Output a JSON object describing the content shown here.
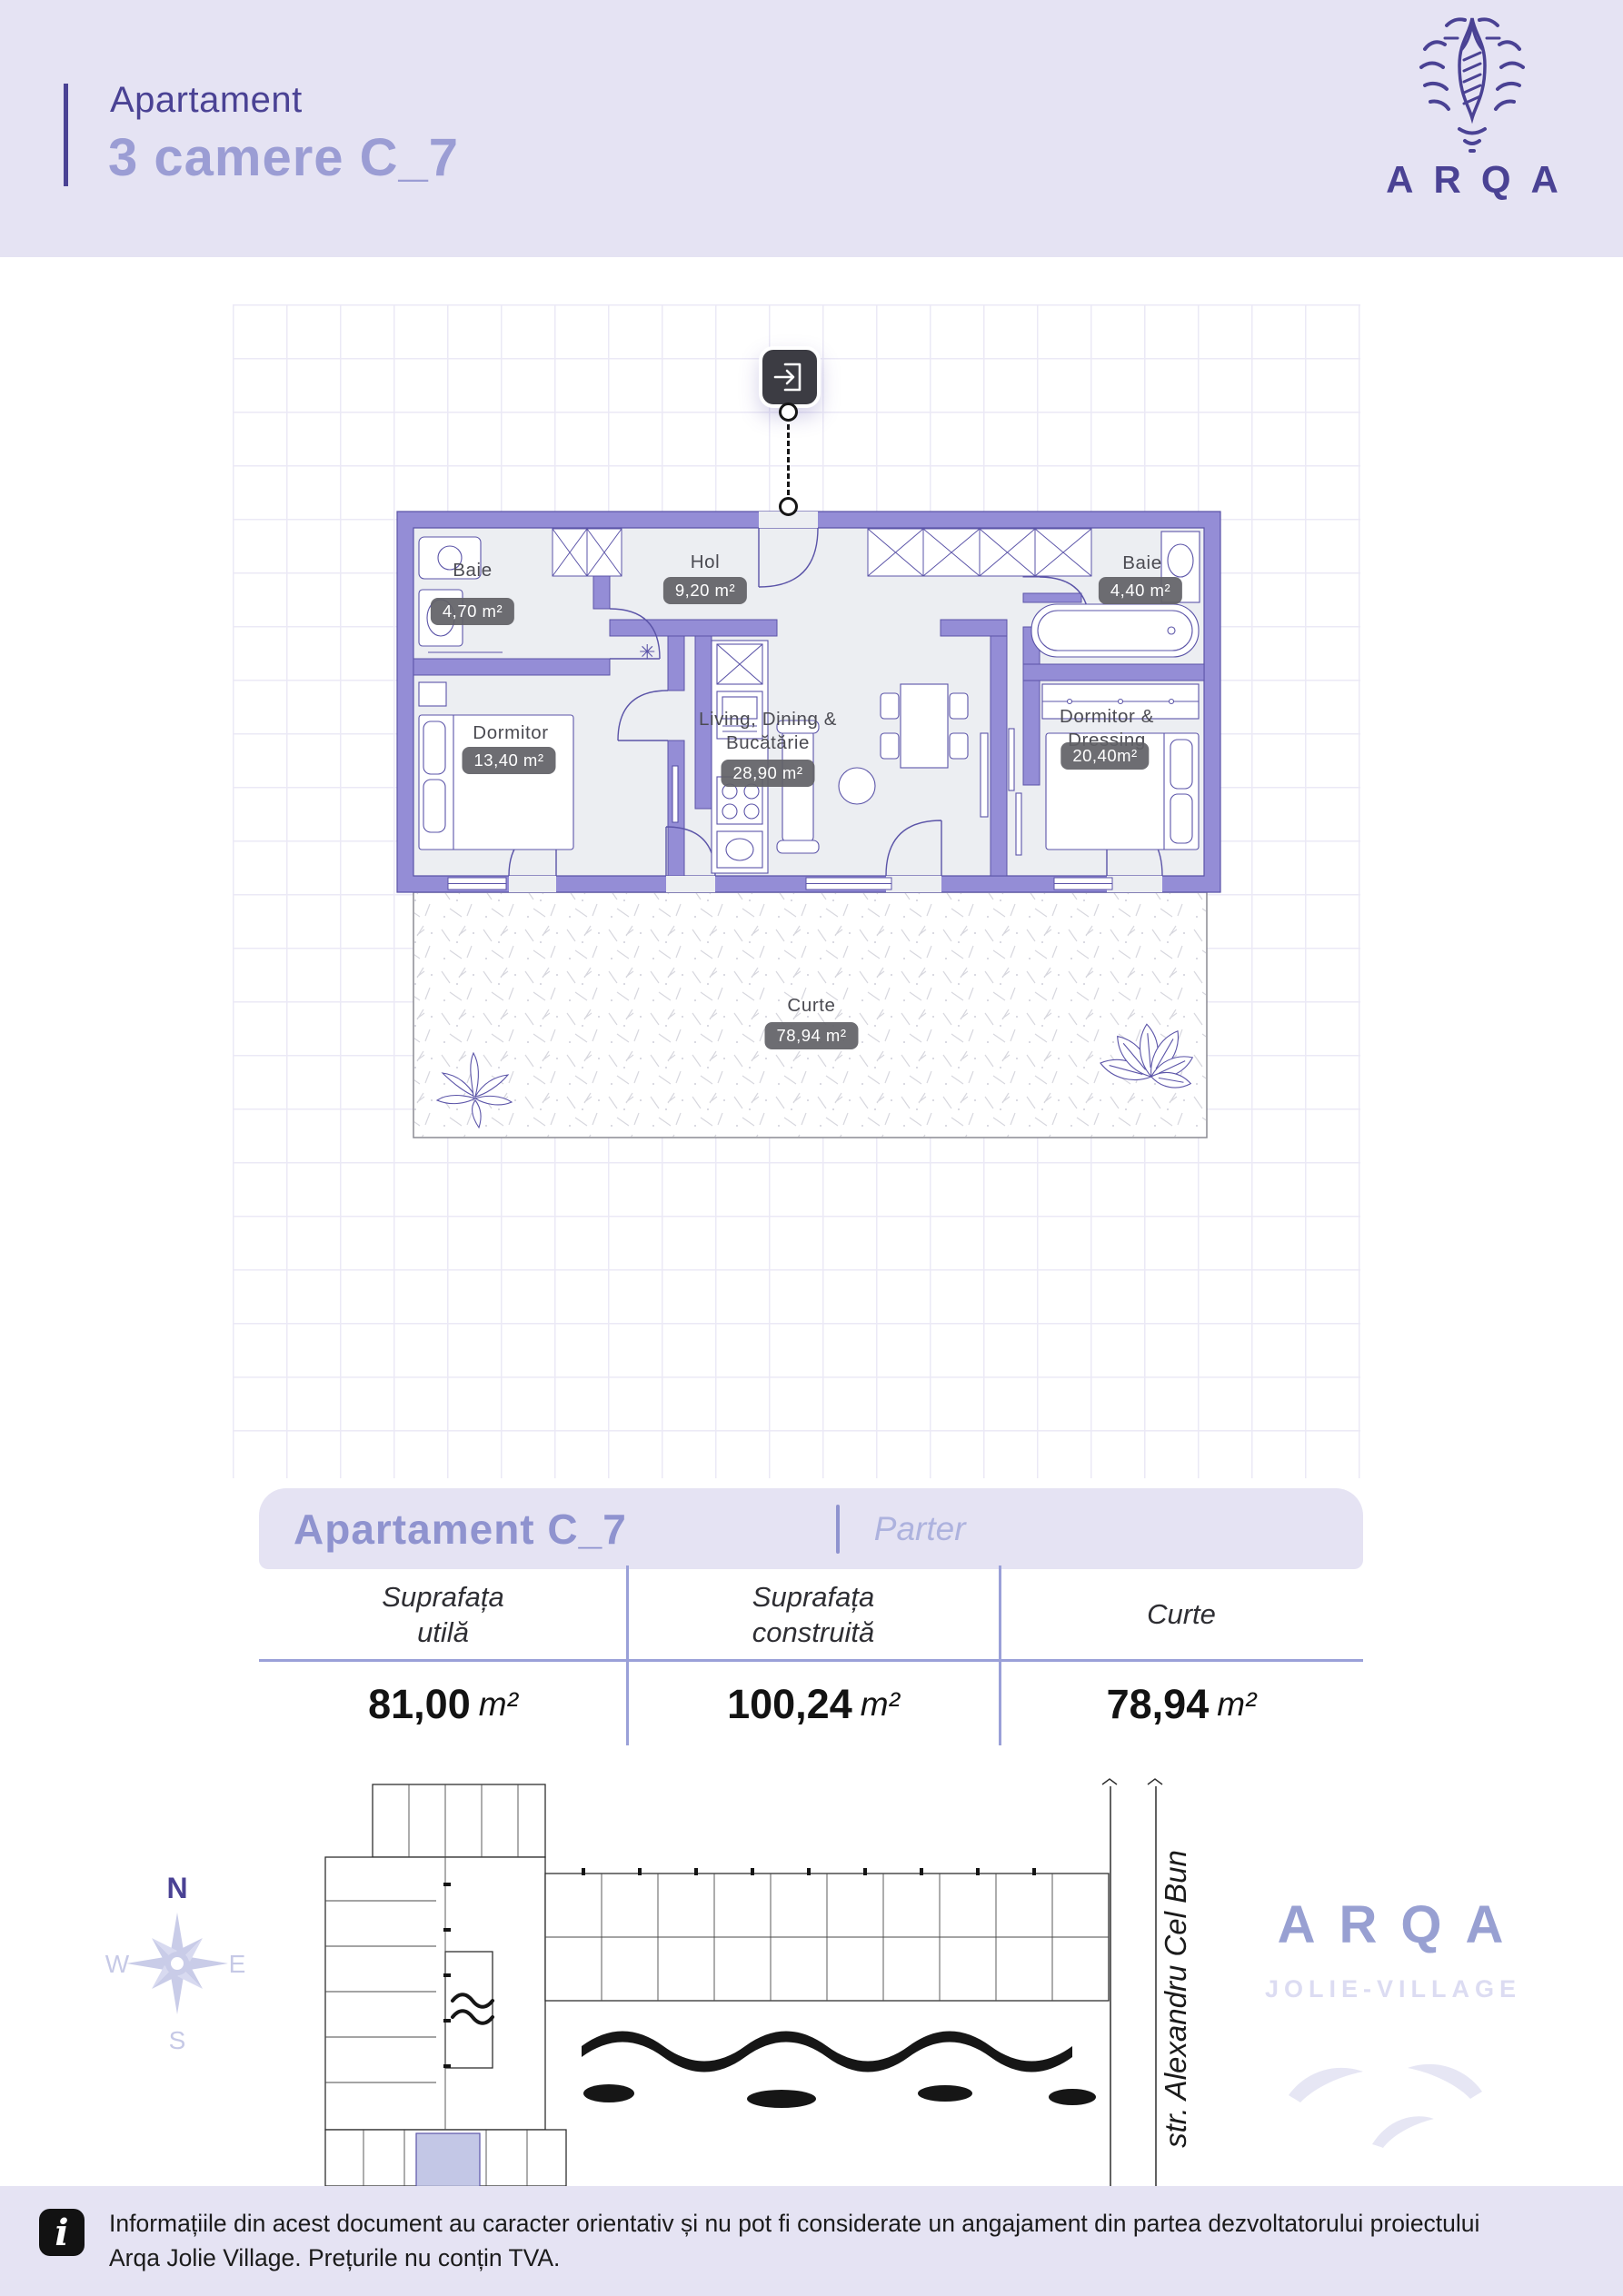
{
  "header": {
    "kicker": "Apartament",
    "title": "3 camere C_7",
    "brand": "ARQA"
  },
  "plan": {
    "rooms": [
      {
        "name": "Baie",
        "area": "4,70 m²"
      },
      {
        "name": "Hol",
        "area": "9,20 m²"
      },
      {
        "name": "Baie",
        "area": "4,40 m²"
      },
      {
        "name": "Dormitor",
        "area": "13,40 m²"
      },
      {
        "name": "Living, Dining &\nBucătărie",
        "area": "28,90 m²"
      },
      {
        "name": "Dormitor & Dressing",
        "area": "20,40m²"
      },
      {
        "name": "Curte",
        "area": "78,94 m²"
      }
    ]
  },
  "summary": {
    "title": "Apartament C_7",
    "floor": "Parter",
    "columns": [
      {
        "label": "Suprafața\nutilă",
        "value": "81,00",
        "unit": "m²"
      },
      {
        "label": "Suprafața\nconstruită",
        "value": "100,24",
        "unit": "m²"
      },
      {
        "label": "Curte",
        "value": "78,94",
        "unit": "m²"
      }
    ]
  },
  "site": {
    "compass": {
      "n": "N",
      "e": "E",
      "s": "S",
      "w": "W"
    },
    "street": "str. Alexandru Cel Bun",
    "brand": "ARQA",
    "brand_sub": "JOLIE-VILLAGE"
  },
  "footer": {
    "text": "Informațiile din acest document au caracter orientativ și nu pot fi considerate un angajament din partea dezvoltatorului proiectului\nArqa Jolie Village. Prețurile nu conțin TVA."
  },
  "colors": {
    "accent_dark": "#4a4294",
    "accent_light": "#9b9dd4",
    "wall_fill": "#948dd6",
    "wall_stroke": "#5b54a8",
    "panel_bg": "#e5e3f3",
    "badge_bg": "#616166",
    "divider": "#9aa0d8",
    "brand_light": "#98a0d2",
    "brand_faint": "#dcdcf2"
  }
}
